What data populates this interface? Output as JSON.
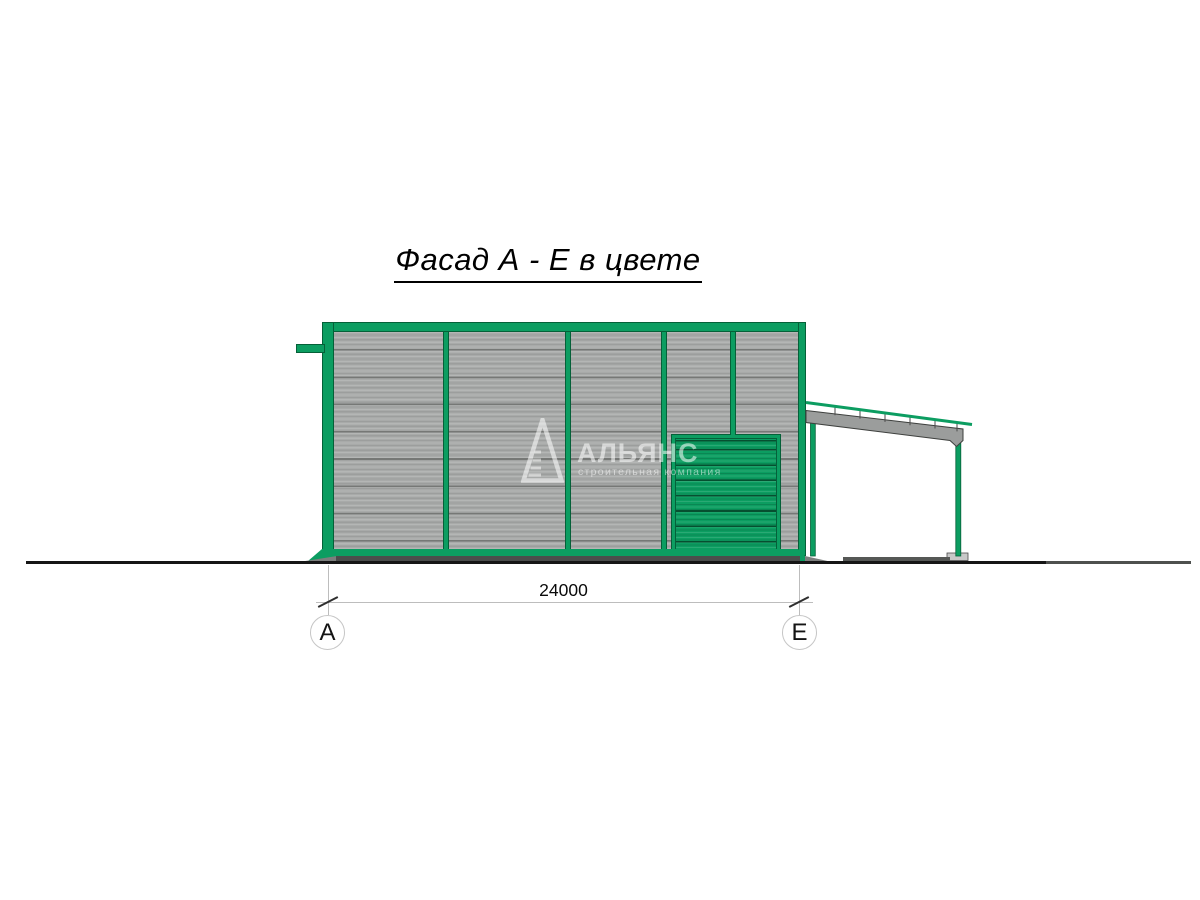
{
  "title": "Фасад А - Е в цвете",
  "dimension": {
    "value": "24000"
  },
  "axes": {
    "left": "А",
    "right": "Е"
  },
  "watermark": {
    "name": "АЛЬЯНС",
    "subtitle": "строительная компания"
  },
  "colors": {
    "brand_green": "#0C9D61",
    "green_outline": "#056038",
    "panel_gray": "#A8AAA9",
    "panel_line": "#767876",
    "beam_gray": "#9B9D9C",
    "ground": "#161616",
    "dim_line": "#BDBDBD"
  }
}
